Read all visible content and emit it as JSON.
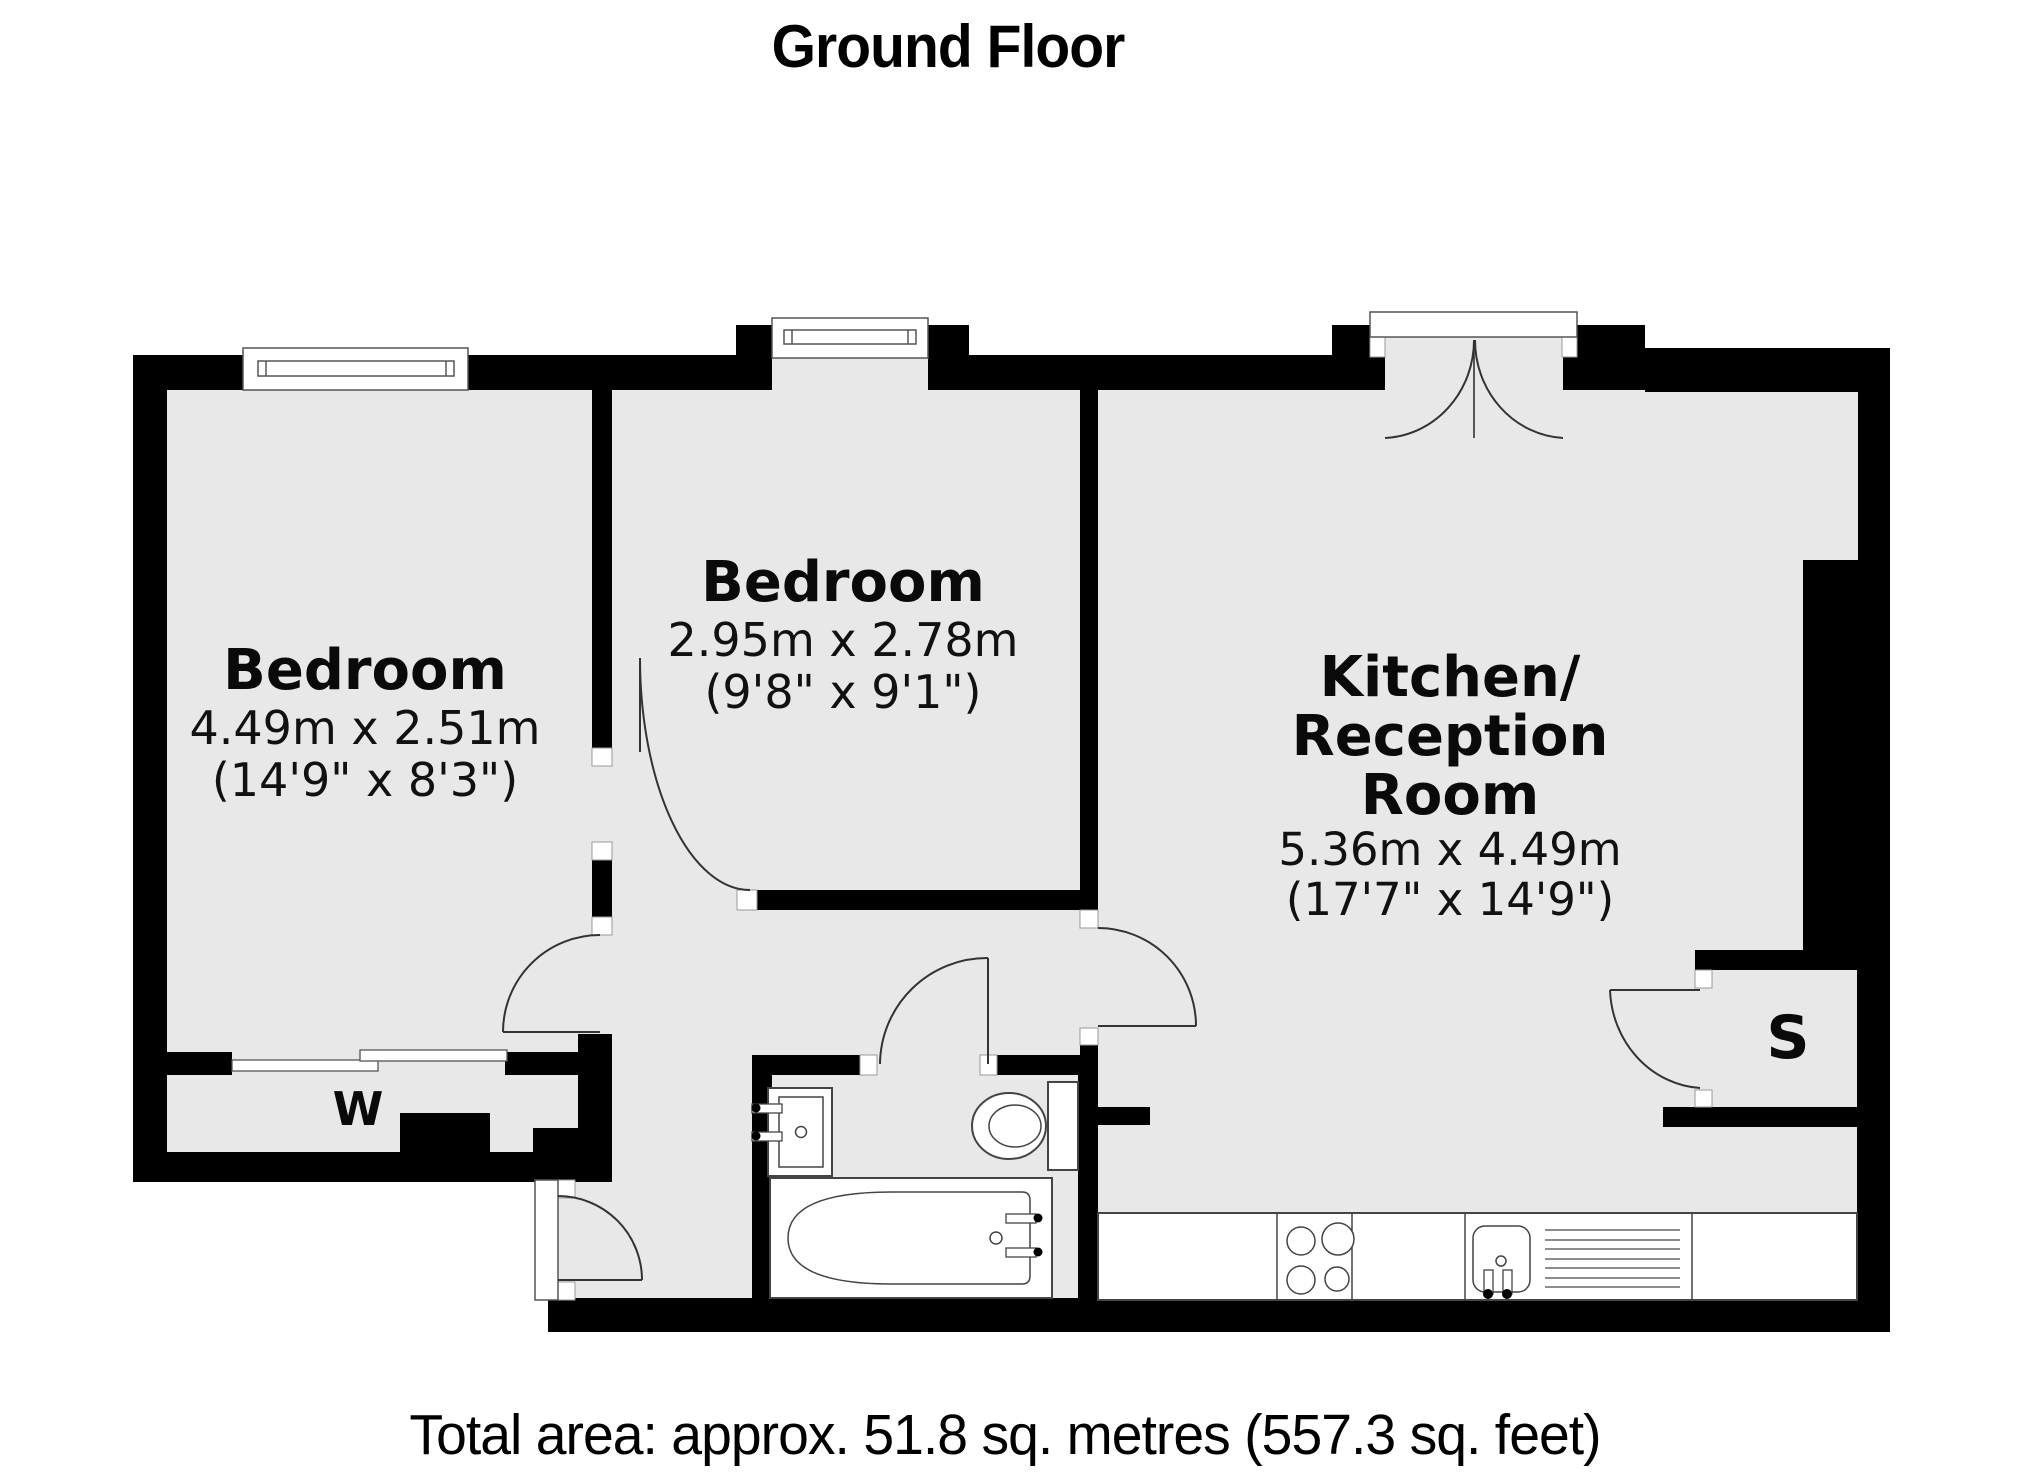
{
  "title": "Ground Floor",
  "footer": {
    "text": "Total area: approx. 51.8 sq. metres (557.3 sq. feet)"
  },
  "rooms": {
    "bedroom1": {
      "name": "Bedroom",
      "dims_metric": "4.49m x 2.51m",
      "dims_imperial": "(14'9\" x 8'3\")"
    },
    "bedroom2": {
      "name": "Bedroom",
      "dims_metric": "2.95m x 2.78m",
      "dims_imperial": "(9'8\" x 9'1\")"
    },
    "kitchen": {
      "name_line1": "Kitchen/",
      "name_line2": "Reception",
      "name_line3": "Room",
      "dims_metric": "5.36m x 4.49m",
      "dims_imperial": "(17'7\" x 14'9\")"
    },
    "wardrobe_label": "W",
    "storage_label": "S"
  },
  "colors": {
    "wall": "#000000",
    "floor": "#e8e8e8",
    "fixture_outline": "#444444",
    "door_arc": "#333333",
    "background": "#ffffff"
  }
}
